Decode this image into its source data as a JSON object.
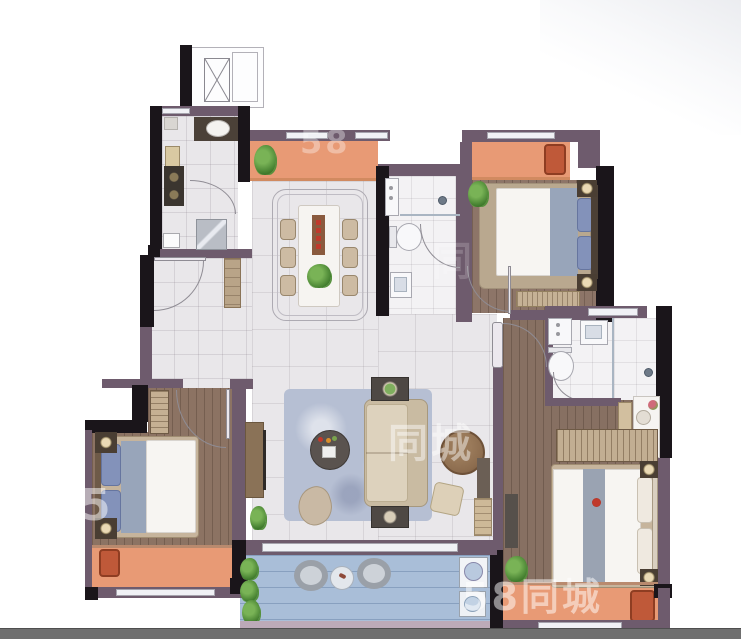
{
  "plan": {
    "type": "residential-floor-plan-top-view",
    "rooms": [
      "elevator-lobby",
      "kitchen",
      "entry-hall",
      "dining-area",
      "living-room",
      "shared-bathroom",
      "north-bedroom",
      "west-bedroom",
      "master-bathroom",
      "dressing-area",
      "master-bedroom",
      "north-balcony-dining",
      "north-balcony-bedroom",
      "west-balcony",
      "south-master-balcony",
      "south-terrace",
      "exterior-light-well"
    ],
    "furniture": [
      "elevator",
      "stair-shaft",
      "kitchen-counter-sink",
      "gas-stove",
      "refrigerator",
      "cutting-board",
      "entry-shoe-cabinet",
      "dining-table",
      "dining-chairs-x6",
      "table-runner-candles",
      "potted-plants",
      "vanity-basin",
      "toilet",
      "shower-head",
      "glass-partition",
      "double-bed",
      "nightstand-lamps",
      "dresser",
      "wardrobe",
      "tv-console",
      "sofa",
      "sofa-side-tables",
      "round-coffee-table",
      "round-wood-table",
      "ottoman",
      "floor-cushion",
      "area-rug",
      "dressing-table",
      "stool",
      "master-double-bed",
      "lounge-armchairs",
      "terrace-armchairs",
      "terrace-round-table",
      "washing-machine",
      "laundry-basin"
    ]
  },
  "watermarks": {
    "brand_center": "同城",
    "brand_bottom": "58同城",
    "brand_top_partial": "58",
    "brand_left_partial": "5",
    "brand_mid_faint": "同"
  },
  "colors": {
    "wall_structural": "#1a151a",
    "wall_masonry": "#6e5b6d",
    "window": "#f0f1f5",
    "balcony_floor": "#e89a75",
    "terrace_floor": "#a9bed8",
    "tile_floor": "#e9e7ea",
    "wood_floor": "#8a7263",
    "bath_floor": "#f3f2f4",
    "accent_armchair": "#bf5939",
    "rug": "#b6bfd3",
    "footer_bar": "#6f6f6f"
  }
}
